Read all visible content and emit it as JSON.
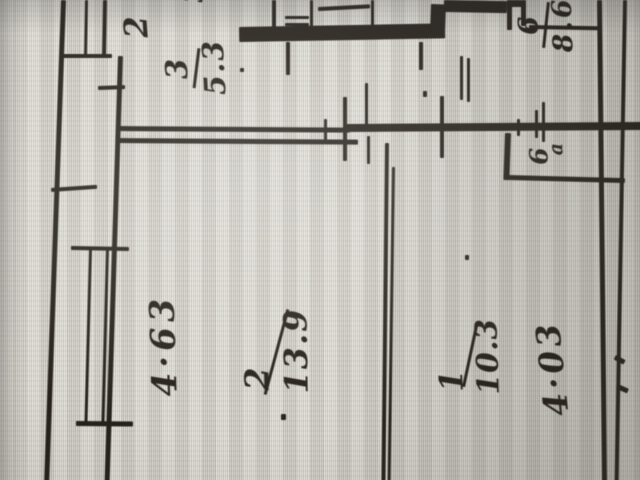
{
  "plan": {
    "type": "apartment floor plan (photographed, rotated 90°)",
    "rooms": [
      {
        "number": "3",
        "area": "5.3"
      },
      {
        "number": "6",
        "area": "8.6"
      },
      {
        "number": "2",
        "area": "13.9"
      },
      {
        "number": "1",
        "area": "10.3"
      }
    ],
    "closet": {
      "number": "6",
      "suffix": "а"
    },
    "dimensions": {
      "top": "2",
      "top_fragment": "3",
      "left": "4·63",
      "right": "4·03"
    },
    "ink_color": "#26211b",
    "paper_color": "#d5d3cb"
  }
}
